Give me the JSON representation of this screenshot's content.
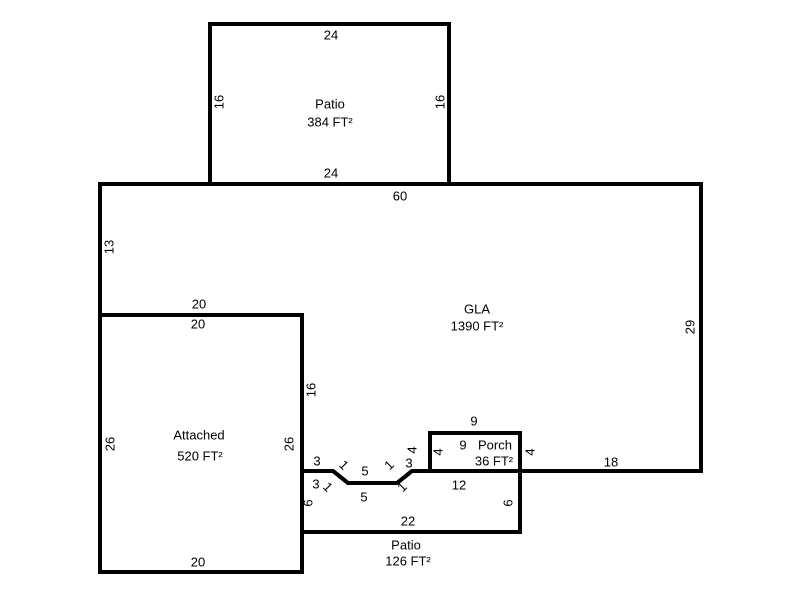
{
  "sketch": {
    "areas": {
      "patio_top": {
        "name": "Patio",
        "area": "384 FT²",
        "width_ft": 24,
        "height_ft": 16
      },
      "gla": {
        "name": "GLA",
        "area": "1390 FT²"
      },
      "attached": {
        "name": "Attached",
        "area": "520 FT²",
        "width_ft": 20,
        "height_ft": 26
      },
      "porch": {
        "name": "Porch",
        "area": "36 FT²",
        "width_ft": 9,
        "height_ft": 4
      },
      "patio_bottom": {
        "name": "Patio",
        "area": "126 FT²",
        "width_ft": 22,
        "height_ft": 6
      }
    },
    "colors": {
      "background": "#ffffff",
      "line": "#000000",
      "text": "#000000"
    },
    "labels": [
      {
        "name": "patio-top-width-top-label",
        "text": "24",
        "x": 331,
        "y": 35,
        "rot": 0
      },
      {
        "name": "patio-top-height-left-label",
        "text": "16",
        "x": 219,
        "y": 102,
        "rot": -90
      },
      {
        "name": "patio-top-name-label",
        "text": "Patio",
        "x": 330,
        "y": 104,
        "rot": 0
      },
      {
        "name": "patio-top-area-label",
        "text": "384 FT²",
        "x": 330,
        "y": 122,
        "rot": 0
      },
      {
        "name": "patio-top-height-right-label",
        "text": "16",
        "x": 440,
        "y": 102,
        "rot": -90
      },
      {
        "name": "patio-top-width-bottom-label",
        "text": "24",
        "x": 331,
        "y": 173,
        "rot": 0
      },
      {
        "name": "gla-top-width-label",
        "text": "60",
        "x": 400,
        "y": 196,
        "rot": 0
      },
      {
        "name": "gla-left-height-label",
        "text": "13",
        "x": 109,
        "y": 247,
        "rot": -90
      },
      {
        "name": "gla-step-width-label",
        "text": "20",
        "x": 199,
        "y": 304,
        "rot": 0
      },
      {
        "name": "gla-left-lower-height-label",
        "text": "16",
        "x": 311,
        "y": 390,
        "rot": -90
      },
      {
        "name": "gla-name-label",
        "text": "GLA",
        "x": 477,
        "y": 309,
        "rot": 0
      },
      {
        "name": "gla-area-label",
        "text": "1390 FT²",
        "x": 477,
        "y": 326,
        "rot": 0
      },
      {
        "name": "gla-right-height-label",
        "text": "29",
        "x": 690,
        "y": 327,
        "rot": -90
      },
      {
        "name": "gla-jog-seg1-label",
        "text": "3",
        "x": 317,
        "y": 461,
        "rot": 0
      },
      {
        "name": "gla-jog-diag1-label",
        "text": "1",
        "x": 344,
        "y": 465,
        "rot": 45
      },
      {
        "name": "gla-jog-seg2-label",
        "text": "5",
        "x": 365,
        "y": 471,
        "rot": 0
      },
      {
        "name": "gla-jog-diag2-label",
        "text": "1",
        "x": 389,
        "y": 465,
        "rot": -45
      },
      {
        "name": "gla-jog-seg3-label",
        "text": "3",
        "x": 409,
        "y": 463,
        "rot": 0
      },
      {
        "name": "gla-porch-left-height-label",
        "text": "4",
        "x": 412,
        "y": 450,
        "rot": -90
      },
      {
        "name": "gla-porch-top-width-label",
        "text": "9",
        "x": 474,
        "y": 421,
        "rot": 0
      },
      {
        "name": "gla-porch-right-height-label",
        "text": "4",
        "x": 530,
        "y": 452,
        "rot": -90
      },
      {
        "name": "gla-bottom-right-width-label",
        "text": "18",
        "x": 611,
        "y": 462,
        "rot": 0
      },
      {
        "name": "porch-left-height-label",
        "text": "4",
        "x": 438,
        "y": 452,
        "rot": -90
      },
      {
        "name": "porch-top-width-label",
        "text": "9",
        "x": 463,
        "y": 445,
        "rot": 0
      },
      {
        "name": "porch-name-label",
        "text": "Porch",
        "x": 495,
        "y": 445,
        "rot": 0
      },
      {
        "name": "porch-area-label",
        "text": "36 FT²",
        "x": 494,
        "y": 461,
        "rot": 0
      },
      {
        "name": "patio-bottom-jog-seg1-label",
        "text": "3",
        "x": 316,
        "y": 484,
        "rot": 0
      },
      {
        "name": "patio-bottom-jog-diag1-label",
        "text": "1",
        "x": 328,
        "y": 487,
        "rot": 45
      },
      {
        "name": "patio-bottom-jog-seg2-label",
        "text": "5",
        "x": 364,
        "y": 497,
        "rot": 0
      },
      {
        "name": "patio-bottom-jog-diag2-label",
        "text": "1",
        "x": 402,
        "y": 487,
        "rot": -45
      },
      {
        "name": "patio-bottom-top-right-width-label",
        "text": "12",
        "x": 459,
        "y": 485,
        "rot": 0
      },
      {
        "name": "patio-bottom-left-height-label",
        "text": "6",
        "x": 308,
        "y": 503,
        "rot": -90
      },
      {
        "name": "patio-bottom-right-height-label",
        "text": "6",
        "x": 508,
        "y": 503,
        "rot": -90
      },
      {
        "name": "patio-bottom-width-label",
        "text": "22",
        "x": 408,
        "y": 521,
        "rot": 0
      },
      {
        "name": "patio-bottom-name-label",
        "text": "Patio",
        "x": 406,
        "y": 545,
        "rot": 0
      },
      {
        "name": "patio-bottom-area-label",
        "text": "126 FT²",
        "x": 408,
        "y": 561,
        "rot": 0
      },
      {
        "name": "attached-top-width-label",
        "text": "20",
        "x": 198,
        "y": 324,
        "rot": 0
      },
      {
        "name": "attached-left-height-label",
        "text": "26",
        "x": 110,
        "y": 444,
        "rot": -90
      },
      {
        "name": "attached-name-label",
        "text": "Attached",
        "x": 199,
        "y": 435,
        "rot": 0
      },
      {
        "name": "attached-area-label",
        "text": "520 FT²",
        "x": 200,
        "y": 456,
        "rot": 0
      },
      {
        "name": "attached-right-height-label",
        "text": "26",
        "x": 289,
        "y": 444,
        "rot": -90
      },
      {
        "name": "attached-bottom-width-label",
        "text": "20",
        "x": 198,
        "y": 562,
        "rot": 0
      }
    ]
  }
}
